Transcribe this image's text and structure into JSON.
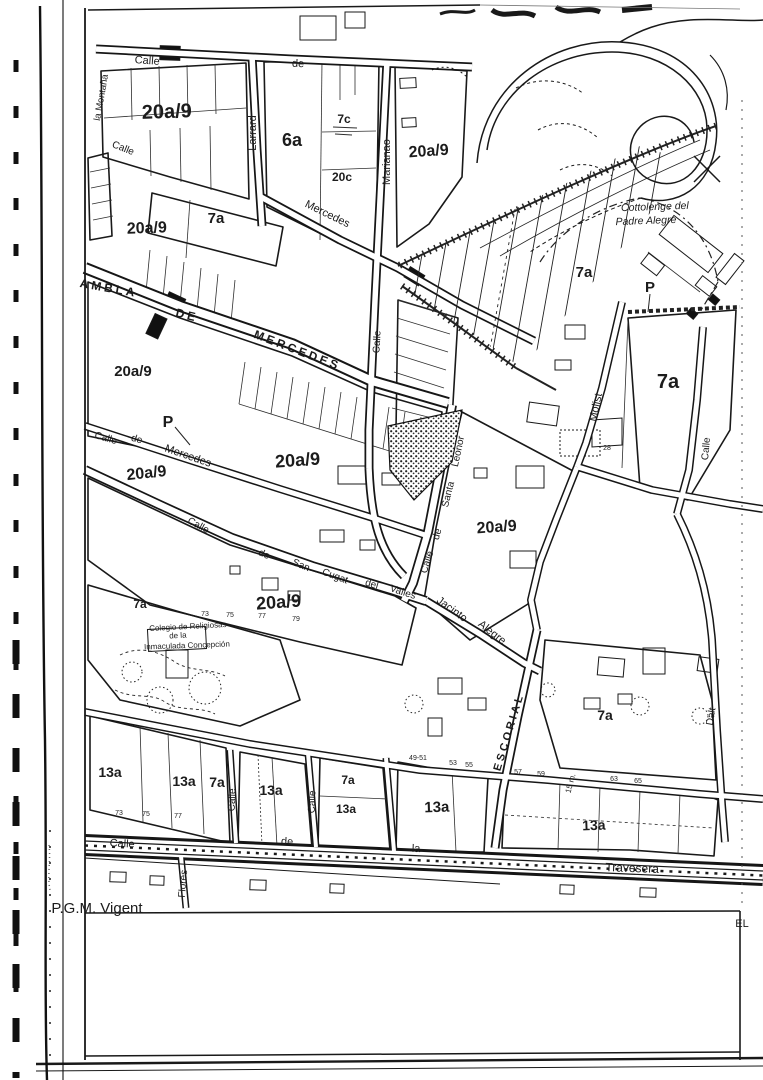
{
  "meta": {
    "description": "Scanned urban planning map sheet (P.G.M. Vigent)",
    "footer_left": "P.G.M. Vigent",
    "footer_right": "EL",
    "ink_color": "#1a1a1a",
    "paper_color": "#ffffff"
  },
  "map": {
    "zoning_codes_present": [
      "20a/9",
      "6a",
      "7a",
      "7c",
      "20c",
      "13a",
      "P"
    ],
    "labels": [
      {
        "t": "20a/9",
        "x": 167,
        "y": 118,
        "s": 20,
        "r": -2,
        "c": "lz"
      },
      {
        "t": "20a/9",
        "x": 147,
        "y": 233,
        "s": 16,
        "r": -2,
        "c": "lz"
      },
      {
        "t": "20a/9",
        "x": 429,
        "y": 156,
        "s": 16,
        "r": -4,
        "c": "lz"
      },
      {
        "t": "20a/9",
        "x": 133,
        "y": 376,
        "s": 15,
        "c": "lz"
      },
      {
        "t": "20a/9",
        "x": 147,
        "y": 478,
        "s": 16,
        "r": -6,
        "c": "lz"
      },
      {
        "t": "20a/9",
        "x": 298,
        "y": 466,
        "s": 18,
        "r": -4,
        "c": "lz"
      },
      {
        "t": "20a/9",
        "x": 497,
        "y": 532,
        "s": 16,
        "r": -4,
        "c": "lz"
      },
      {
        "t": "20a/9",
        "x": 279,
        "y": 608,
        "s": 18,
        "r": -4,
        "c": "lz"
      },
      {
        "t": "6a",
        "x": 292,
        "y": 146,
        "s": 18,
        "c": "lz"
      },
      {
        "t": "7c",
        "x": 344,
        "y": 123,
        "s": 12,
        "c": "lz"
      },
      {
        "t": "20c",
        "x": 342,
        "y": 181,
        "s": 12,
        "c": "lz"
      },
      {
        "t": "7a",
        "x": 216,
        "y": 223,
        "s": 15,
        "c": "lz"
      },
      {
        "t": "7a",
        "x": 584,
        "y": 277,
        "s": 15,
        "c": "lz"
      },
      {
        "t": "7a",
        "x": 668,
        "y": 388,
        "s": 20,
        "c": "lz"
      },
      {
        "t": "7a",
        "x": 605,
        "y": 720,
        "s": 14,
        "c": "lz"
      },
      {
        "t": "7a",
        "x": 217,
        "y": 787,
        "s": 14,
        "c": "lz"
      },
      {
        "t": "13a",
        "x": 110,
        "y": 777,
        "s": 14,
        "c": "lz"
      },
      {
        "t": "13a",
        "x": 184,
        "y": 786,
        "s": 14,
        "c": "lz"
      },
      {
        "t": "13a",
        "x": 271,
        "y": 795,
        "s": 14,
        "c": "lz"
      },
      {
        "t": "7a",
        "x": 348,
        "y": 784,
        "s": 12,
        "c": "lz"
      },
      {
        "t": "13a",
        "x": 346,
        "y": 813,
        "s": 12,
        "c": "lz"
      },
      {
        "t": "13a",
        "x": 437,
        "y": 812,
        "s": 15,
        "r": -2,
        "c": "lz"
      },
      {
        "t": "13a",
        "x": 594,
        "y": 830,
        "s": 14,
        "r": -2,
        "c": "lz"
      },
      {
        "t": "7a",
        "x": 140,
        "y": 608,
        "s": 12,
        "c": "lz"
      },
      {
        "t": "P",
        "x": 168,
        "y": 427,
        "s": 16,
        "c": "lz"
      },
      {
        "t": "P",
        "x": 650,
        "y": 292,
        "s": 15,
        "c": "lz"
      },
      {
        "t": "Calle",
        "x": 147,
        "y": 64,
        "r": 4,
        "s": 11,
        "c": "ls"
      },
      {
        "t": "de",
        "x": 298,
        "y": 67,
        "r": 2,
        "s": 11,
        "c": "ls"
      },
      {
        "t": "Larrard",
        "x": 256,
        "y": 133,
        "r": -90,
        "s": 11,
        "c": "ls"
      },
      {
        "t": "Marianao",
        "x": 390,
        "y": 162,
        "r": -90,
        "s": 11,
        "c": "ls"
      },
      {
        "t": "Mercedes",
        "x": 326,
        "y": 217,
        "r": 26,
        "s": 11,
        "c": "ls"
      },
      {
        "t": "AMBLA",
        "x": 108,
        "y": 292,
        "r": 10,
        "s": 12,
        "c": "lc"
      },
      {
        "t": "DE",
        "x": 186,
        "y": 319,
        "r": 14,
        "s": 12,
        "c": "lc"
      },
      {
        "t": "MERCEDES",
        "x": 296,
        "y": 354,
        "r": 21,
        "s": 12,
        "c": "lc"
      },
      {
        "t": "Calle",
        "x": 380,
        "y": 342,
        "r": -87,
        "s": 10,
        "c": "ls"
      },
      {
        "t": "Calle",
        "x": 122,
        "y": 151,
        "r": 22,
        "s": 10,
        "c": "ls"
      },
      {
        "t": "la Montaña",
        "x": 104,
        "y": 98,
        "r": -80,
        "s": 9.5,
        "c": "ls"
      },
      {
        "t": "Calle",
        "x": 105,
        "y": 441,
        "r": 16,
        "s": 10,
        "c": "ls"
      },
      {
        "t": "de",
        "x": 136,
        "y": 442,
        "r": 16,
        "s": 10,
        "c": "ls"
      },
      {
        "t": "Mercedes",
        "x": 187,
        "y": 459,
        "r": 19,
        "s": 11,
        "c": "ls"
      },
      {
        "t": "Calle",
        "x": 197,
        "y": 528,
        "r": 28,
        "s": 10,
        "c": "ls"
      },
      {
        "t": "de",
        "x": 263,
        "y": 557,
        "r": 24,
        "s": 10,
        "c": "ls"
      },
      {
        "t": "San",
        "x": 300,
        "y": 568,
        "r": 22,
        "s": 10,
        "c": "ls"
      },
      {
        "t": "Cugat",
        "x": 334,
        "y": 579,
        "r": 20,
        "s": 10,
        "c": "ls"
      },
      {
        "t": "del",
        "x": 371,
        "y": 587,
        "r": 16,
        "s": 10,
        "c": "ls"
      },
      {
        "t": "Valles",
        "x": 402,
        "y": 595,
        "r": 18,
        "s": 10,
        "c": "ls"
      },
      {
        "t": "Calle",
        "x": 430,
        "y": 563,
        "r": -72,
        "s": 10,
        "c": "ls"
      },
      {
        "t": "de",
        "x": 440,
        "y": 535,
        "r": -74,
        "s": 10,
        "c": "ls"
      },
      {
        "t": "Santa",
        "x": 451,
        "y": 495,
        "r": -76,
        "s": 10,
        "c": "ls"
      },
      {
        "t": "Leonor",
        "x": 461,
        "y": 452,
        "r": -78,
        "s": 10,
        "c": "ls"
      },
      {
        "t": "Jacinto",
        "x": 450,
        "y": 612,
        "r": 36,
        "s": 11,
        "c": "ls"
      },
      {
        "t": "Alegre",
        "x": 490,
        "y": 635,
        "r": 38,
        "s": 11,
        "c": "ls"
      },
      {
        "t": "ESCORIAL",
        "x": 512,
        "y": 733,
        "r": -73,
        "s": 11,
        "c": "lc"
      },
      {
        "t": "Molist",
        "x": 599,
        "y": 408,
        "r": -78,
        "s": 11,
        "c": "ls"
      },
      {
        "t": "Calle",
        "x": 709,
        "y": 449,
        "r": -85,
        "s": 10,
        "c": "ls"
      },
      {
        "t": "Calle",
        "x": 235,
        "y": 800,
        "r": -88,
        "s": 10,
        "c": "ls"
      },
      {
        "t": "Calle",
        "x": 315,
        "y": 802,
        "r": -88,
        "s": 10,
        "c": "ls"
      },
      {
        "t": "Flores",
        "x": 186,
        "y": 884,
        "r": -85,
        "s": 10,
        "c": "ls"
      },
      {
        "t": "Calle",
        "x": 122,
        "y": 847,
        "r": 3,
        "s": 11,
        "c": "ls"
      },
      {
        "t": "de",
        "x": 287,
        "y": 845,
        "r": 2,
        "s": 11,
        "c": "ls"
      },
      {
        "t": "la",
        "x": 416,
        "y": 852,
        "r": 2,
        "s": 11,
        "c": "ls"
      },
      {
        "t": "Travesera",
        "x": 632,
        "y": 872,
        "r": 2,
        "s": 12,
        "c": "ls"
      },
      {
        "t": "Dalt",
        "x": 714,
        "y": 717,
        "r": -80,
        "s": 10,
        "c": "ls"
      },
      {
        "t": "15 m.",
        "x": 573,
        "y": 784,
        "r": -75,
        "s": 8,
        "c": "ls"
      },
      {
        "t": "Cottolenge del",
        "x": 655,
        "y": 210,
        "r": -2,
        "s": 10.5,
        "i": 1,
        "c": "ln"
      },
      {
        "t": "Padre Alegre",
        "x": 646,
        "y": 224,
        "r": -2,
        "s": 10.5,
        "i": 1,
        "c": "ln"
      },
      {
        "t": "Colegio de Religiosas",
        "x": 188,
        "y": 629,
        "r": -3,
        "s": 8,
        "c": "ln"
      },
      {
        "t": "de la",
        "x": 178,
        "y": 638,
        "r": -3,
        "s": 8,
        "c": "ln"
      },
      {
        "t": "Inmaculada Concepción",
        "x": 187,
        "y": 648,
        "r": -2,
        "s": 8,
        "c": "ln"
      },
      {
        "t": "P.G.M. Vigent",
        "x": 97,
        "y": 913,
        "s": 15,
        "c": "lf",
        "a": "start"
      },
      {
        "t": "EL",
        "x": 742,
        "y": 927,
        "s": 11,
        "c": "lf",
        "a": "start"
      },
      {
        "t": "73",
        "x": 119,
        "y": 815,
        "s": 7,
        "c": "lt"
      },
      {
        "t": "75",
        "x": 146,
        "y": 816,
        "s": 7,
        "c": "lt"
      },
      {
        "t": "77",
        "x": 178,
        "y": 818,
        "s": 7,
        "c": "lt"
      },
      {
        "t": "73",
        "x": 205,
        "y": 616,
        "s": 7,
        "c": "lt"
      },
      {
        "t": "75",
        "x": 230,
        "y": 617,
        "s": 7,
        "c": "lt"
      },
      {
        "t": "77",
        "x": 262,
        "y": 618,
        "s": 7,
        "c": "lt"
      },
      {
        "t": "79",
        "x": 296,
        "y": 621,
        "s": 7,
        "c": "lt"
      },
      {
        "t": "57",
        "x": 518,
        "y": 774,
        "s": 7,
        "c": "lt"
      },
      {
        "t": "59",
        "x": 541,
        "y": 776,
        "s": 7,
        "c": "lt"
      },
      {
        "t": "63",
        "x": 614,
        "y": 781,
        "s": 7,
        "c": "lt"
      },
      {
        "t": "65",
        "x": 638,
        "y": 783,
        "s": 7,
        "c": "lt"
      },
      {
        "t": "49-51",
        "x": 418,
        "y": 760,
        "s": 7,
        "c": "lt"
      },
      {
        "t": "53",
        "x": 453,
        "y": 765,
        "s": 7,
        "c": "lt"
      },
      {
        "t": "55",
        "x": 469,
        "y": 767,
        "s": 7,
        "c": "lt"
      },
      {
        "t": "28",
        "x": 607,
        "y": 450,
        "s": 7,
        "c": "lt"
      }
    ]
  }
}
